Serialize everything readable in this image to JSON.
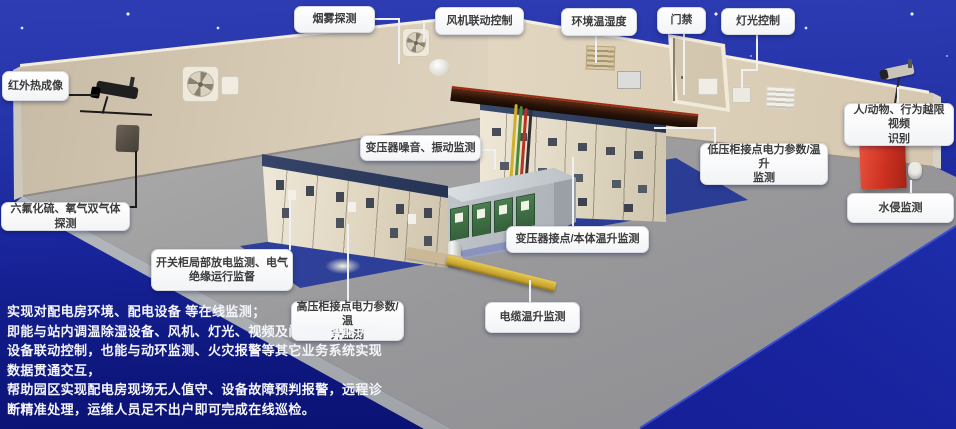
{
  "callouts": [
    {
      "id": "smoke-detection",
      "label": "烟雾探测"
    },
    {
      "id": "fan-linkage-control",
      "label": "风机联动控制"
    },
    {
      "id": "env-temp-humidity",
      "label": "环境温湿度"
    },
    {
      "id": "door-access",
      "label": "门禁"
    },
    {
      "id": "light-control",
      "label": "灯光控制"
    },
    {
      "id": "infrared-thermal-imaging",
      "label": "红外热成像"
    },
    {
      "id": "person-animal-video-recognition",
      "label": "人/动物、行为越限视频\n识别"
    },
    {
      "id": "sf6-o2-dual-gas-detection",
      "label": "六氟化硫、氧气双气体探测"
    },
    {
      "id": "water-intrusion-monitoring",
      "label": "水侵监测"
    },
    {
      "id": "transformer-noise-vibration",
      "label": "变压器噪音、振动监测"
    },
    {
      "id": "lv-cabinet-power-temp",
      "label": "低压柜接点电力参数/温升\n监测"
    },
    {
      "id": "transformer-contact-body-temp",
      "label": "变压器接点/本体温升监测"
    },
    {
      "id": "switchgear-partial-discharge",
      "label": "开关柜局部放电监测、电气\n绝缘运行监督"
    },
    {
      "id": "hv-cabinet-power-temp",
      "label": "高压柜接点电力参数/温\n升监测"
    },
    {
      "id": "cable-temp-monitoring",
      "label": "电缆温升监测"
    }
  ],
  "description": {
    "text": "实现对配电房环境、配电设备 等在线监测；\n即能与站内调温除湿设备、风机、灯光、视频及门禁等智能执行\n设备联动控制，也能与动环监测、火灾报警等其它业务系统实现\n数据贯通交互，\n帮助园区实现配电房现场无人值守、设备故障预判报警，远程诊\n断精准处理，运维人员足不出户即可完成在线巡检。"
  },
  "colors": {
    "sky_blue": "#2433a8",
    "deep_blue": "#0a1172",
    "wall_beige": "#ddd1bb",
    "floor_gray": "#9b9b9d",
    "mat_blue": "#2b3e98",
    "alert_red": "#cc3020",
    "duct_yellow": "#d8b83c",
    "cabinet_top_navy": "#2f3a55",
    "callout_bg": "#ffffff",
    "callout_text": "#3c3c3c"
  }
}
